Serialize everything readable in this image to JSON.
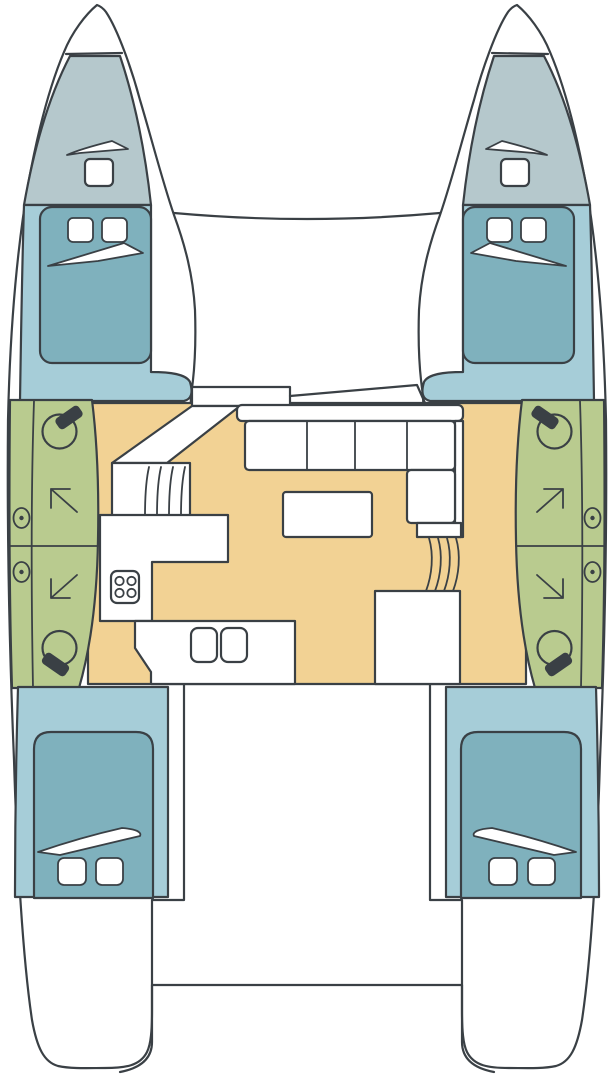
{
  "diagram": {
    "kind": "catamaran-floor-plan",
    "view": "top-down deck and accommodation layout",
    "text_labels": [],
    "regions": {
      "port_bow_locker": "anchor locker",
      "port_foredeck": "forward deck with hatch and vent",
      "port_forward_cabin": "double berth cabin with two pillows and blanket",
      "port_head": "bathroom with two toilets, shower arrows and two portholes",
      "port_aft_cabin": "double berth cabin with two pillows and blanket",
      "starboard_bow_locker": "anchor locker",
      "starboard_foredeck": "forward deck with hatch and vent",
      "starboard_forward_cabin": "double berth cabin with two pillows and blanket",
      "starboard_head": "bathroom with two toilets, shower arrows and two portholes",
      "starboard_aft_cabin": "double berth cabin with two pillows and blanket",
      "trampoline": "foredeck area between bows",
      "salon": "main salon with L-settee and table",
      "galley": "galley with 4-burner stove and double sink",
      "cockpit": "aft cockpit between hulls",
      "stern_platform": "aft crossbeam / swim platform"
    },
    "counts": {
      "cabins": 4,
      "beds": 4,
      "toilets": 4,
      "portholes": 4,
      "shower_arrows": 4,
      "deck_hatches": 2,
      "stove_burners": 4,
      "sink_bowls": 2,
      "settee_seats": 4,
      "stair_flights": 2
    }
  },
  "colors": {
    "ink": "#3a4045",
    "paper": "#ffffff",
    "foredeck_grey": "#b5c8cc",
    "cabin_blue": "#a6cdd8",
    "bed_teal": "#7fb1bd",
    "bath_green": "#b9cb8f",
    "salon_tan": "#f2d294",
    "tank_black": "#16181a"
  }
}
